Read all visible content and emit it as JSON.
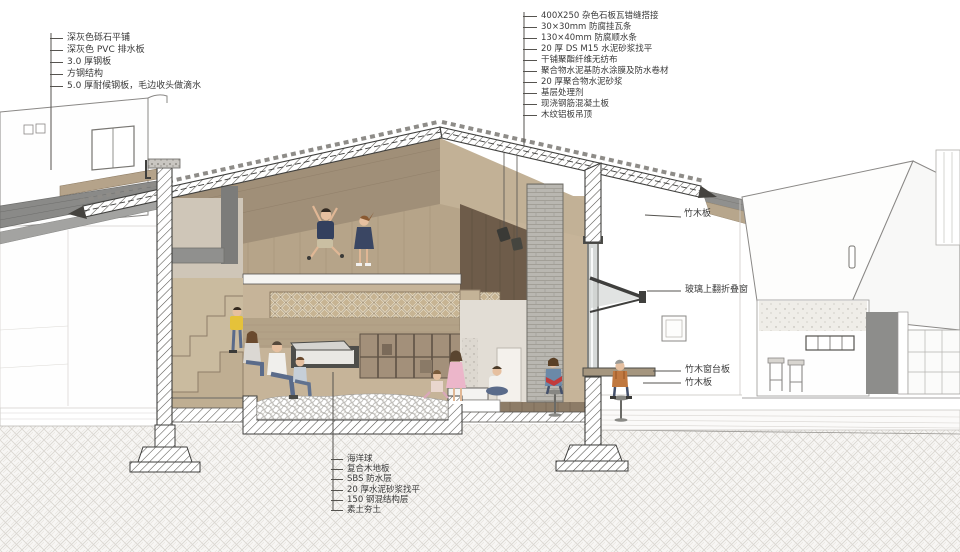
{
  "annotations": {
    "roof_left_layers": {
      "items": [
        "深灰色砾石平铺",
        "深灰色 PVC 排水板",
        "3.0 厚钢板",
        "方钢结构",
        "5.0 厚耐候钢板，毛边收头做滴水"
      ]
    },
    "roof_right_layers": {
      "items": [
        "400X250 杂色石板瓦错缝搭接",
        "30×30mm 防腐挂瓦条",
        "130×40mm 防腐顺水条",
        "20 厚 DS M15 水泥砂浆找平",
        "干铺聚酯纤维无纺布",
        "聚合物水泥基防水涂膜及防水卷材",
        "20 厚聚合物水泥砂浆",
        "基层处理剂",
        "现浇钢筋混凝土板",
        "木纹铝板吊顶"
      ]
    },
    "right_side": {
      "items": [
        "竹木板",
        "玻璃上翻折叠窗",
        "竹木窗台板",
        "竹木板"
      ]
    },
    "floor_layers": {
      "items": [
        "海洋球",
        "复合木地板",
        "SBS 防水层",
        "20 厚水泥砂浆找平",
        "150 钢混结构层",
        "素土夯土"
      ]
    }
  },
  "colors": {
    "wood_light": "#c2b196",
    "wood_mid": "#a8957a",
    "wood_dark": "#6e5c4a",
    "cut_hatch_line": "#55534f",
    "earth_hatch_line": "#d6d3cd",
    "brick_gray": "#b9b7b1",
    "annex_roof_gray": "#8a8a88",
    "accent_navy": "#33405e",
    "accent_yellow": "#e5c23a",
    "accent_pink": "#ecb6ca",
    "label_text": "#3a3a3a"
  }
}
